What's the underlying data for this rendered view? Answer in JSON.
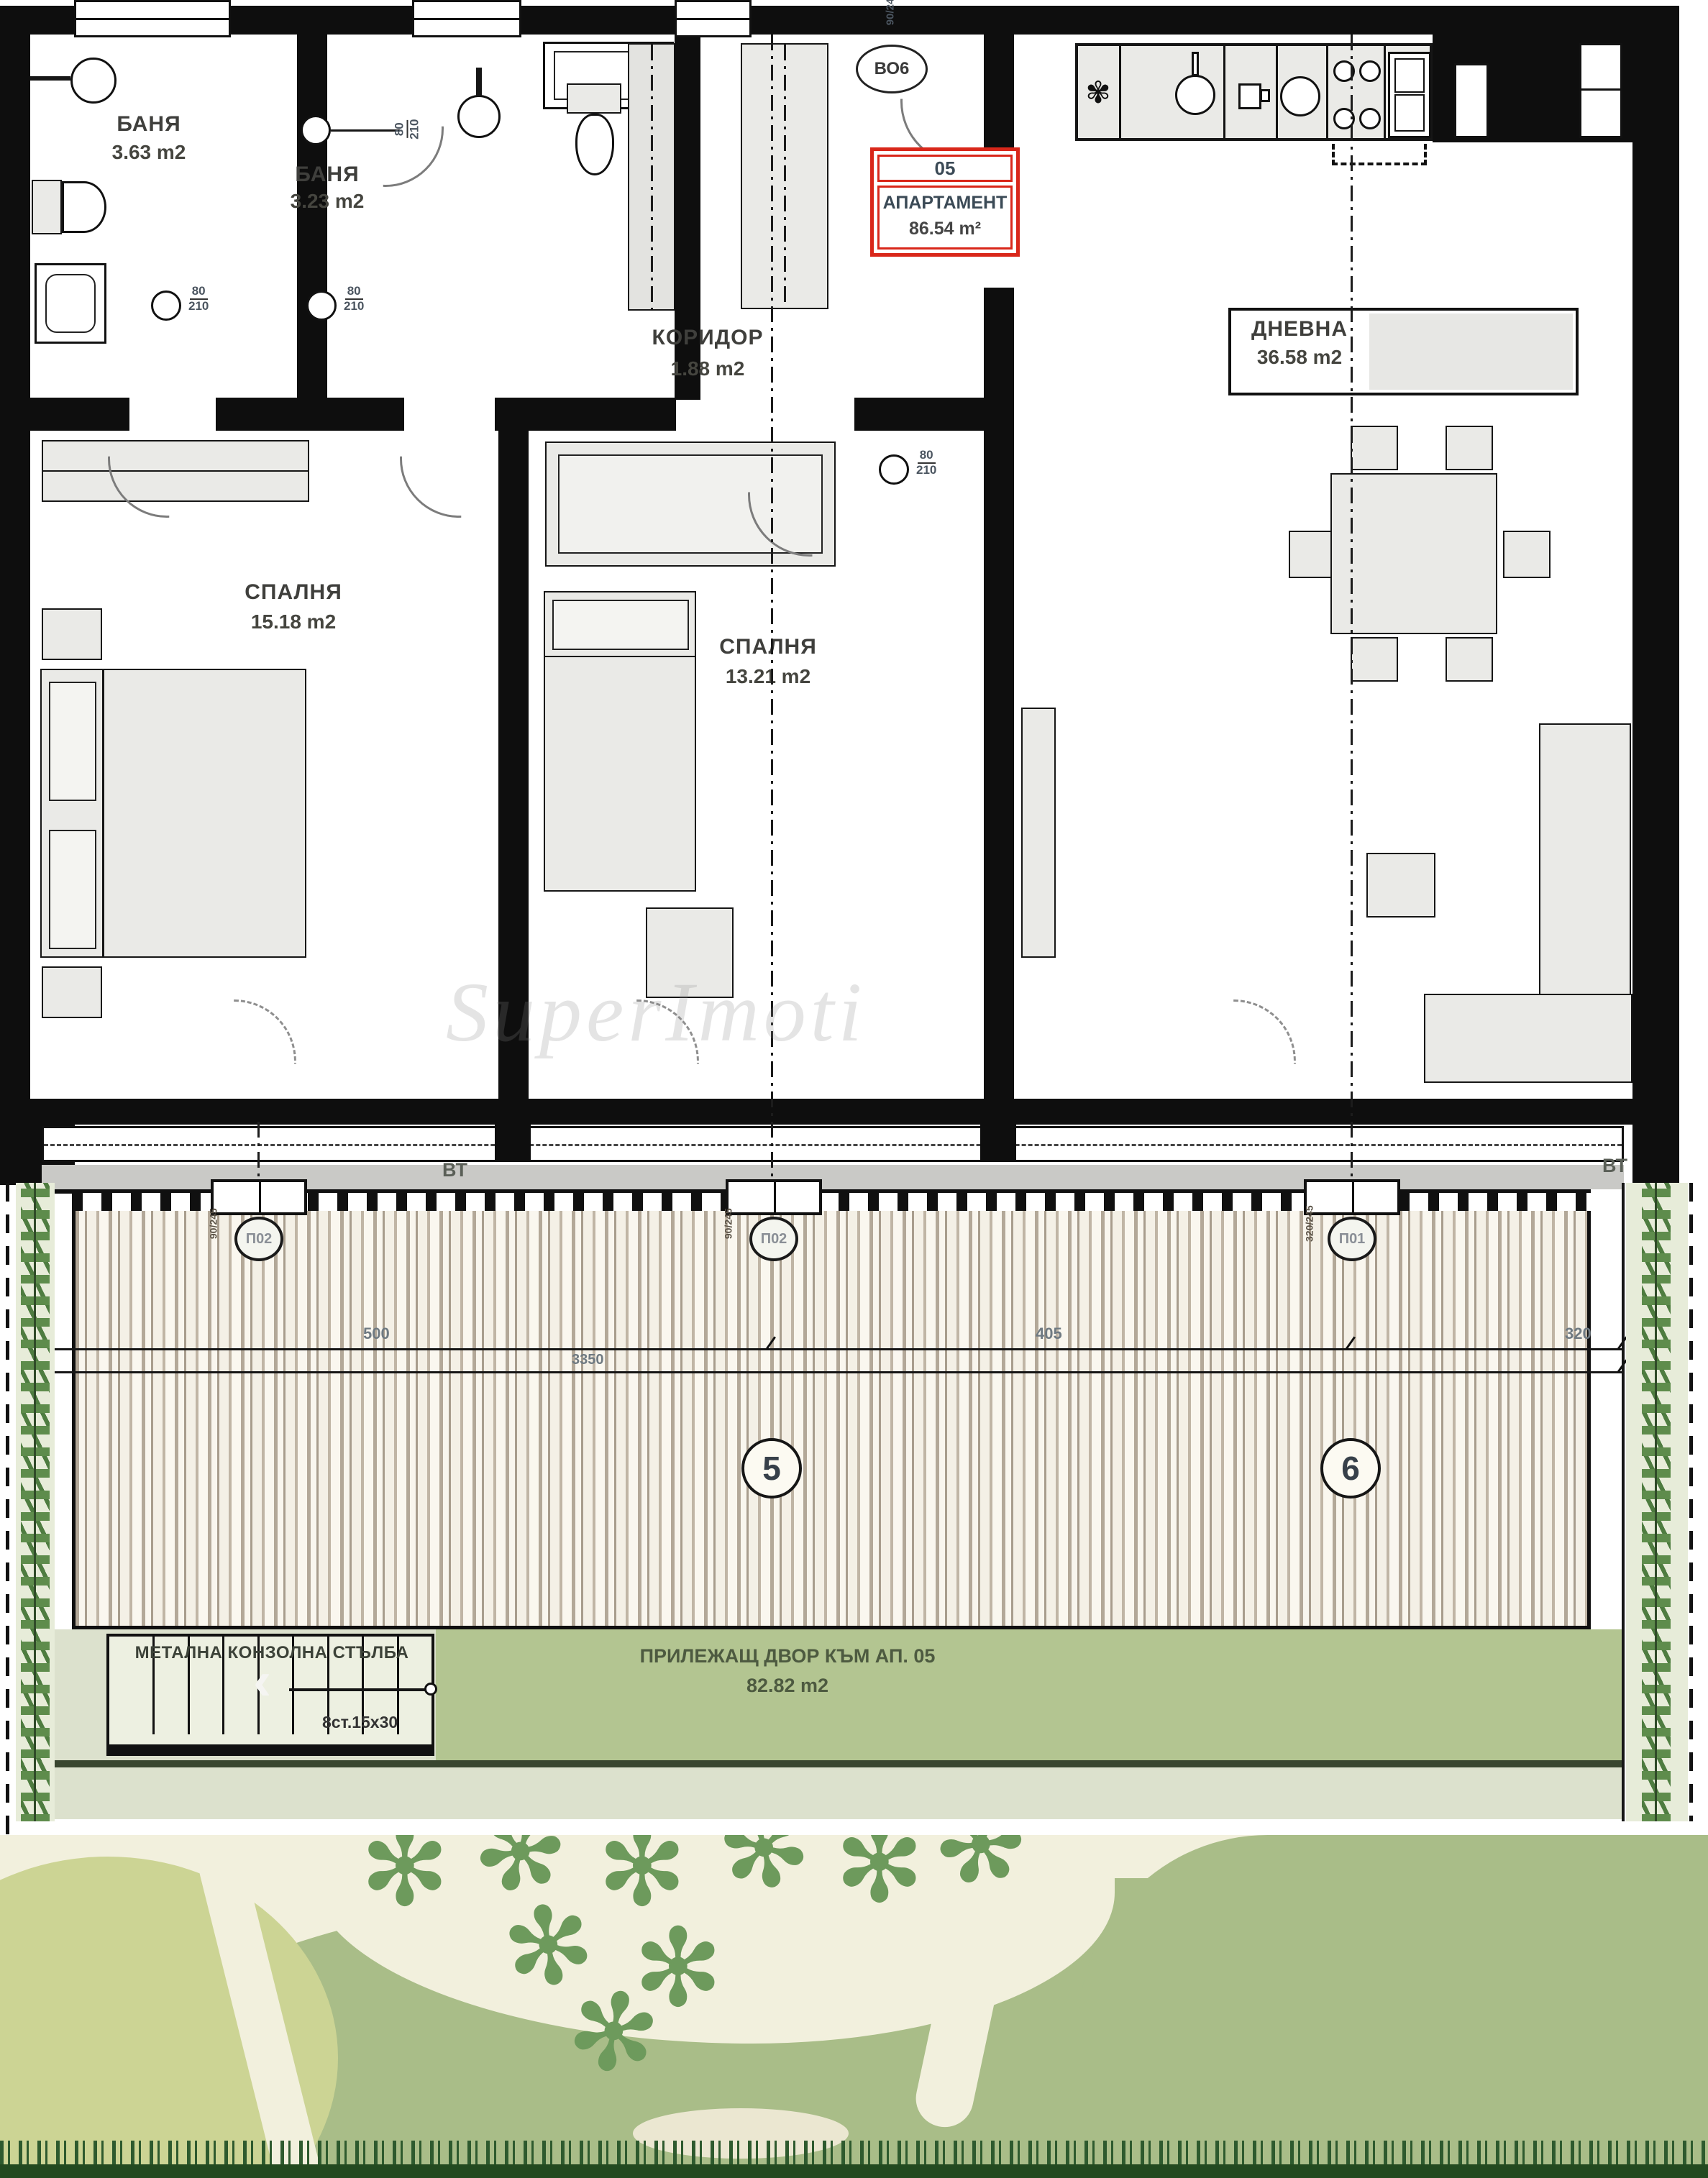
{
  "plan": {
    "rooms": [
      {
        "name": "БАНЯ",
        "area": "3.63 m2"
      },
      {
        "name": "БАНЯ",
        "area": "3.23 m2"
      },
      {
        "name": "КОРИДОР",
        "area": "1.88 m2"
      },
      {
        "name": "СПАЛНЯ",
        "area": "15.18 m2"
      },
      {
        "name": "СПАЛНЯ",
        "area": "13.21 m2"
      },
      {
        "name": "ДНЕВНА",
        "area": "36.58 m2"
      }
    ],
    "apartment_tag": {
      "number": "05",
      "label": "АПАРТАМЕНТ",
      "area": "86.54 m²"
    },
    "doors": [
      {
        "w": "80",
        "h": "210"
      },
      {
        "w": "80",
        "h": "210"
      },
      {
        "w": "80",
        "h": "210"
      },
      {
        "w": "80",
        "h": "210"
      }
    ],
    "entry": {
      "code": "ВО6",
      "dim": "90/240"
    }
  },
  "terrace": {
    "vt": "ВТ",
    "windows": [
      {
        "code": "П02",
        "dim": "90/245"
      },
      {
        "code": "П02",
        "dim": "90/245"
      },
      {
        "code": "П01",
        "dim": "320/245"
      }
    ],
    "axes": [
      "5",
      "6"
    ],
    "dims": {
      "left": "500",
      "mid": "3350",
      "right": "405",
      "far_right": "320"
    }
  },
  "yard": {
    "stair_title": "МЕТАЛНА КОНЗОЛНА СТЪЛБА",
    "stair_steps": "8ст.15х30",
    "label": "ПРИЛЕЖАЩ ДВОР КЪМ АП. 05",
    "area": "82.82 m2"
  },
  "icons": {
    "grass": "✻",
    "vent": "✾",
    "stair_arrow": "‹"
  },
  "colors": {
    "wall": "#0e0e0e",
    "tag_red": "#d9271a",
    "deck_slat": "#b3a898",
    "yard_green": "#b3c591",
    "garden_green": "#a9bd88"
  },
  "watermark": "SuperImoti"
}
